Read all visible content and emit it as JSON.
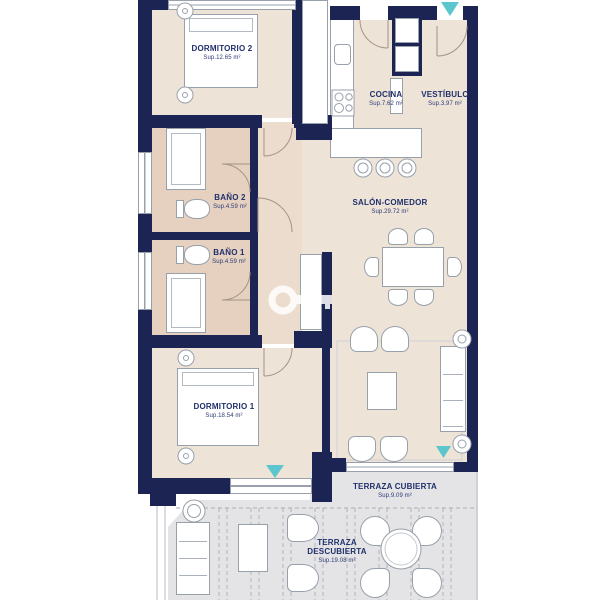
{
  "floorplan": {
    "rooms": {
      "dormitorio2": {
        "name": "DORMITORIO 2",
        "area": "Sup.12.65 m²"
      },
      "cocina": {
        "name": "COCINA",
        "area": "Sup.7.62 m²"
      },
      "vestibulo": {
        "name": "VESTÍBULO",
        "area": "Sup.3.97 m²"
      },
      "bano2": {
        "name": "BAÑO 2",
        "area": "Sup.4.59 m²"
      },
      "bano1": {
        "name": "BAÑO 1",
        "area": "Sup.4.59 m²"
      },
      "salon": {
        "name": "SALÓN-COMEDOR",
        "area": "Sup.29.72 m²"
      },
      "dormitorio1": {
        "name": "DORMITORIO 1",
        "area": "Sup.18.54 m²"
      },
      "terrazaCubierta": {
        "name": "TERRAZA CUBIERTA",
        "area": "Sup.9.09 m²"
      },
      "terrazaDescubierta": {
        "name": "TERRAZA DESCUBIERTA",
        "area": "Sup.19.08 m²"
      }
    },
    "colors": {
      "wall": "#1b2453",
      "room_floor": "#eee3d7",
      "bath_floor": "#e6d1c1",
      "hall_floor": "#ecdccd",
      "terrace_floor": "#e4e4e6",
      "entrance_marker": "#5bc6cd",
      "label_text": "#21306b"
    }
  }
}
